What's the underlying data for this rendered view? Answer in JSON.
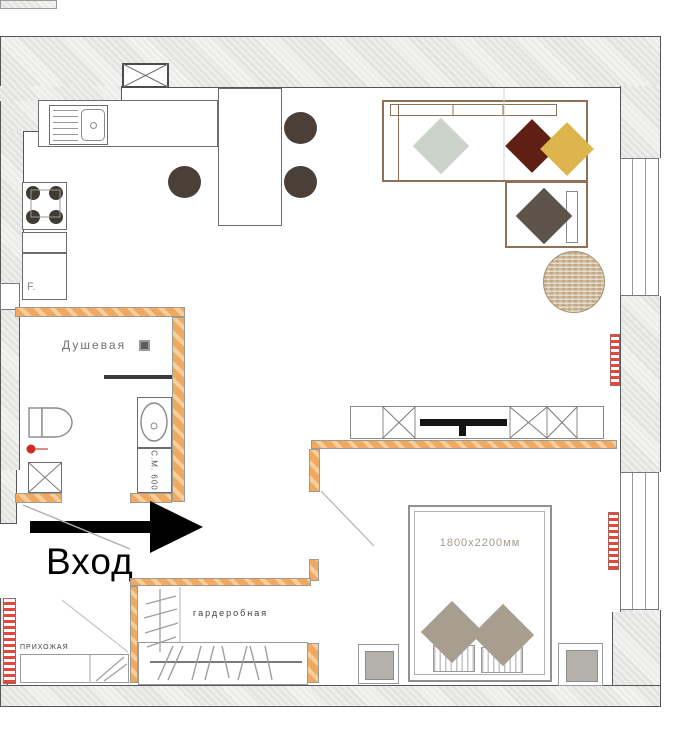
{
  "title": "apartment-floor-plan",
  "labels": {
    "entrance": "Вход",
    "shower_room": "Душевая",
    "wardrobe_room": "гардеробная",
    "hallway": "ПРИХОЖАЯ",
    "bed_dimensions": "1800x2200мм",
    "washing_machine": "С.М. 600",
    "fridge": "F."
  },
  "colors": {
    "wall_hatch": "#e3e3e1",
    "partition_wall_orange": "#f0a95e",
    "sofa_outline": "#8d7258",
    "pillow_sage": "#ccd3ca",
    "pillow_maroon": "#601f15",
    "pillow_yellow": "#deb54d",
    "pillow_taupe": "#5d5349",
    "bed_pillow_taupe": "#a79e90",
    "stool_brown": "#4a4037",
    "rug_tan": "#ceb99b",
    "radiator_red": "#e2483c",
    "entrance_arrow": "#000000"
  },
  "furniture_icons": [
    "corner-sofa",
    "sofa-pillow-sage",
    "sofa-pillow-maroon",
    "sofa-pillow-yellow",
    "sofa-pillow-taupe",
    "round-rug",
    "kitchen-island",
    "bar-stool",
    "kitchen-sink",
    "stove",
    "fridge",
    "ventilation-shaft",
    "toilet",
    "washbasin",
    "washing-machine",
    "shower-partition",
    "tv-console",
    "tv",
    "double-bed",
    "bed-pillow",
    "nightstand",
    "wardrobe-rail",
    "hallway-cabinet",
    "radiator",
    "window",
    "entrance-arrow",
    "door-swing"
  ],
  "rooms_visible_labels": [
    "Душевая",
    "гардеробная",
    "ПРИХОЖАЯ"
  ]
}
